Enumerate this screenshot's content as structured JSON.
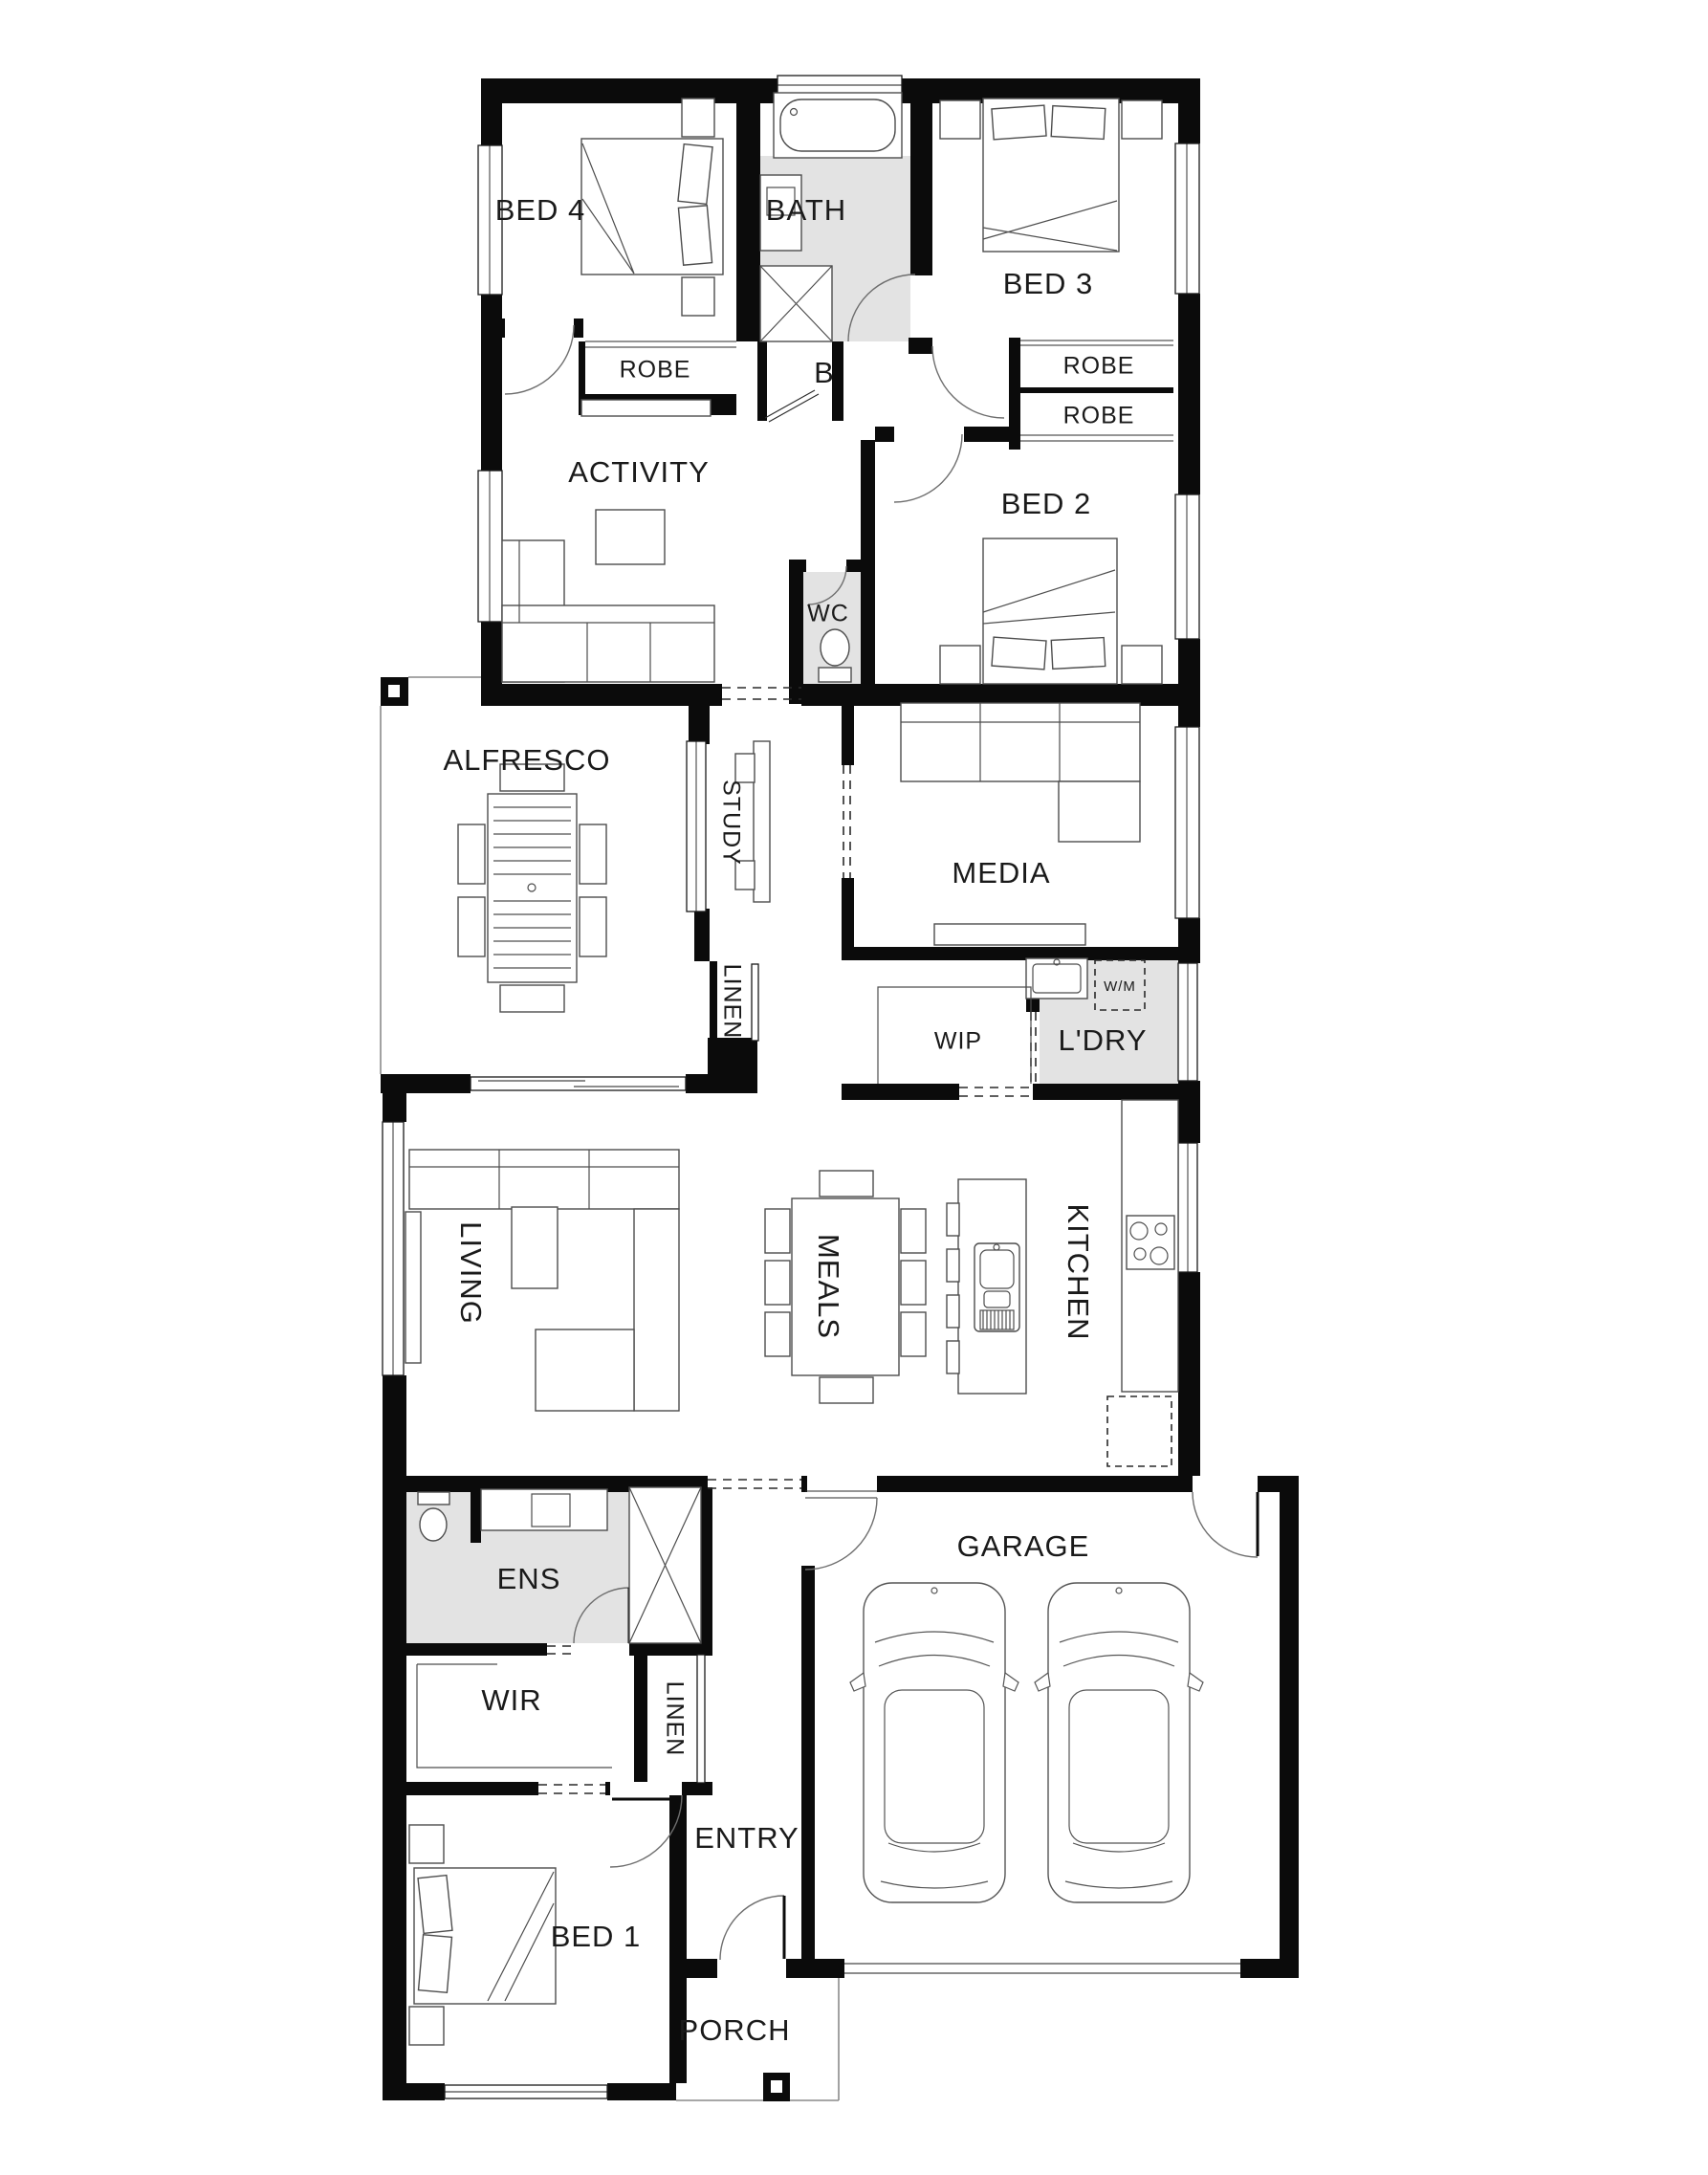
{
  "title": "Single storey house floor plan",
  "colors": {
    "wall": "#0b0b0b",
    "wet_floor": "#e3e3e3",
    "label": "#1a1a1a",
    "furniture_line": "#4d4d4d"
  },
  "rooms": {
    "bed4": "BED 4",
    "bath": "BATH",
    "bed3": "BED 3",
    "robe_bed4": "ROBE",
    "b_closet": "B",
    "robe_bed3_upper": "ROBE",
    "robe_bed3_lower": "ROBE",
    "activity": "ACTIVITY",
    "wc": "WC",
    "bed2": "BED 2",
    "alfresco": "ALFRESCO",
    "study": "STUDY",
    "media": "MEDIA",
    "linen_hall": "LINEN",
    "wip": "WIP",
    "ldry": "L'DRY",
    "wm": "W/M",
    "living": "LIVING",
    "meals": "MEALS",
    "kitchen": "KITCHEN",
    "ens": "ENS",
    "wir": "WIR",
    "linen_entry": "LINEN",
    "garage": "GARAGE",
    "entry": "ENTRY",
    "bed1": "BED 1",
    "porch": "PORCH"
  }
}
